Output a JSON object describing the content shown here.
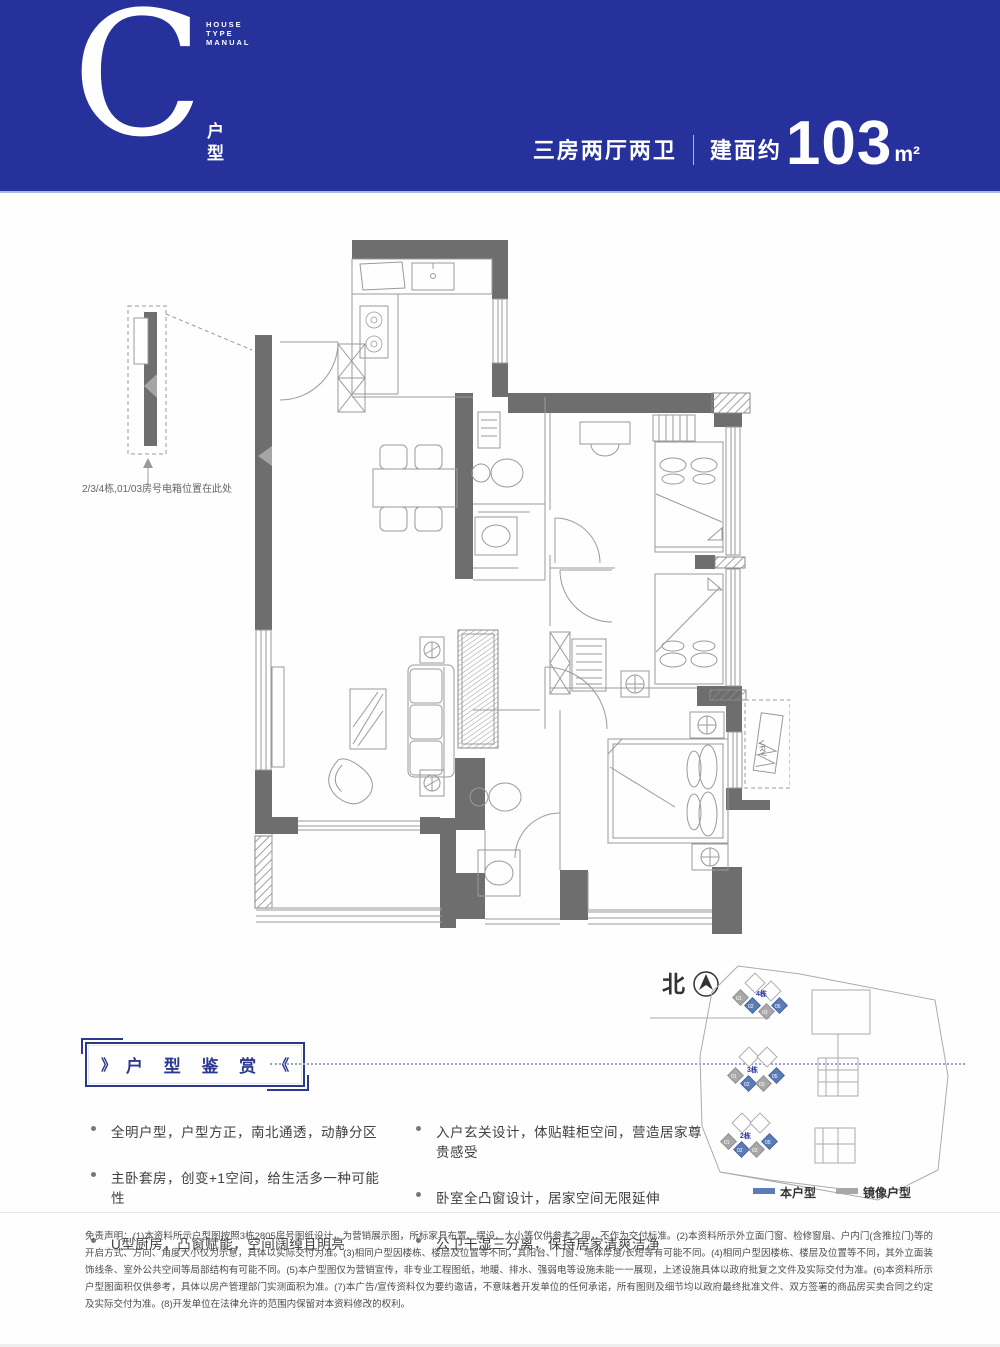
{
  "header": {
    "letter": "C",
    "letter_label": "户型",
    "manual_caption": "HOUSE\nTYPE\nMANUAL",
    "spec": "三房两厅两卫",
    "area_prefix": "建面约",
    "area_value": "103",
    "area_unit": "m²",
    "bg_color": "#27319b"
  },
  "plan": {
    "electric_box_note": "2/3/4栋,01/03房号电箱位置在此处",
    "vrv_label": "VRV"
  },
  "features": {
    "title": "户 型 鉴 赏",
    "chevron_left": "》",
    "chevron_right": "《",
    "left": [
      "全明户型，户型方正，南北通透，动静分区",
      "主卧套房，创变+1空间，给生活多一种可能性",
      "U型厨房，凸窗赋能，空间阔绰且明亮"
    ],
    "right": [
      "入户玄关设计，体贴鞋柜空间，营造居家尊贵感受",
      "卧室全凸窗设计，居家空间无限延伸",
      "公卫干湿三分离，保持居家清爽洁净"
    ]
  },
  "site_plan": {
    "north_label": "北",
    "buildings": [
      "4栋",
      "3栋",
      "2栋"
    ],
    "unit_labels": [
      "01",
      "02",
      "03",
      "05"
    ],
    "legend": [
      {
        "label": "本户型",
        "color": "#5c7cb8"
      },
      {
        "label": "镜像户型",
        "color": "#a8a8a8"
      }
    ]
  },
  "disclaimer": "免责声明：(1)本资料所示户型图按照3栋2805房号图纸设计，为营销展示图，所标家具布置、摆设、大小等仅供参考之用，不作为交付标准。(2)本资料所示外立面门窗、检修窗扇、户内门(含推拉门)等的开启方式、方向、角度大小仅为示意，具体以实际交付为准。(3)相同户型因楼栋、楼层及位置等不同，其阳台、门窗、墙体厚度/长短等有可能不同。(4)相同户型因楼栋、楼层及位置等不同，其外立面装饰线条、室外公共空间等局部结构有可能不同。(5)本户型图仅为营销宣传，非专业工程图纸，地暖、排水、强弱电等设施未能一一展现，上述设施具体以政府批复之文件及实际交付为准。(6)本资料所示户型图面积仅供参考，具体以房产管理部门实测面积为准。(7)本广告/宣传资料仅为要约邀请，不意味着开发单位的任何承诺，所有图则及细节均以政府最终批准文件、双方签署的商品房买卖合同之约定及实际交付为准。(8)开发单位在法律允许的范围内保留对本资料修改的权利。"
}
